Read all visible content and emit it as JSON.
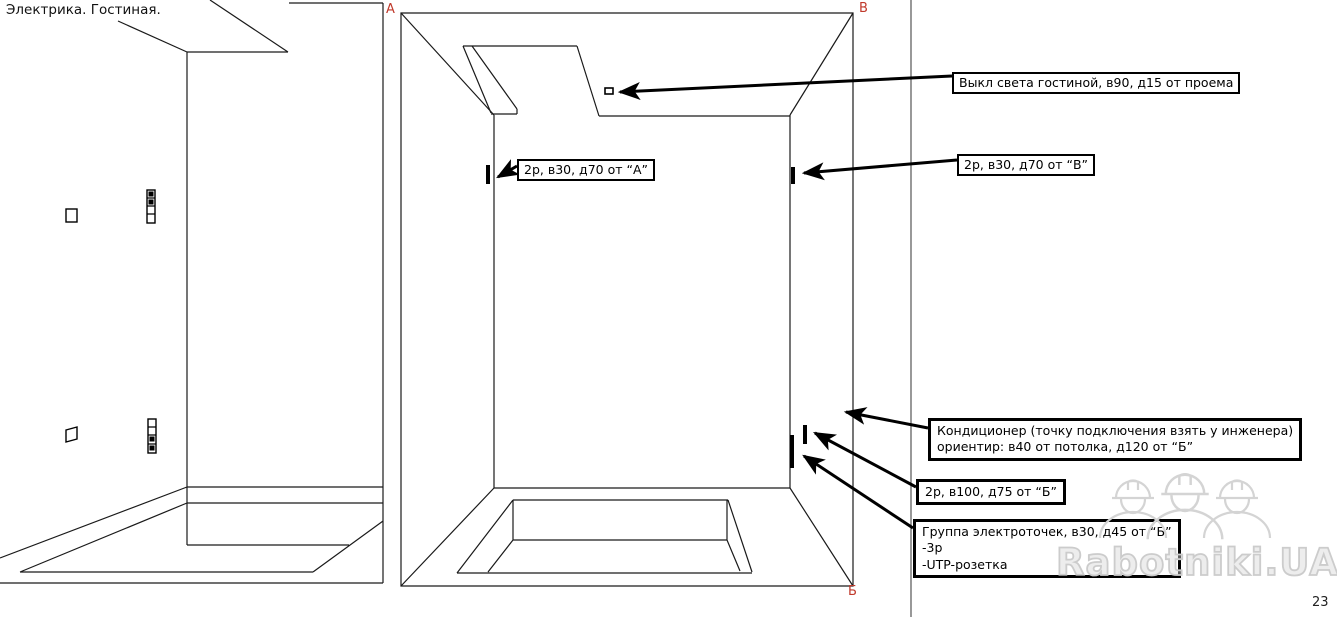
{
  "meta": {
    "sheet_title": "Электрика. Гостиная.",
    "page_number": "23"
  },
  "corner_labels": {
    "a": "А",
    "v": "В",
    "b": "Б"
  },
  "callouts": {
    "light_switch": {
      "text": "Выкл света гостиной, в90, д15 от проема"
    },
    "outlet_from_a": {
      "text": "2р, в30, д70 от “А”"
    },
    "outlet_from_v": {
      "text": "2р, в30, д70 от “В”"
    },
    "air_conditioner": {
      "lines": [
        "Кондиционер (точку подключения взять у инженера)",
        "ориентир: в40 от потолка, д120 от “Б”"
      ]
    },
    "outlet_b100": {
      "text": "2р, в100, д75 от “Б”"
    },
    "outlet_group": {
      "lines": [
        "Группа электроточек, в30, д45 от “Б”",
        "-3р",
        "-UTP-розетка"
      ]
    }
  },
  "watermark": {
    "text": "Rabotniki.UA"
  },
  "icons": {
    "switch": "light-switch-symbol",
    "socket_tick": "socket-mark-symbol",
    "socket_group": "socket-group-symbol",
    "worker": "hard-hat-worker-figure"
  },
  "colors": {
    "line": "#1a1a1a",
    "label_red": "#c0392b",
    "watermark_gray": "#cccccc"
  }
}
